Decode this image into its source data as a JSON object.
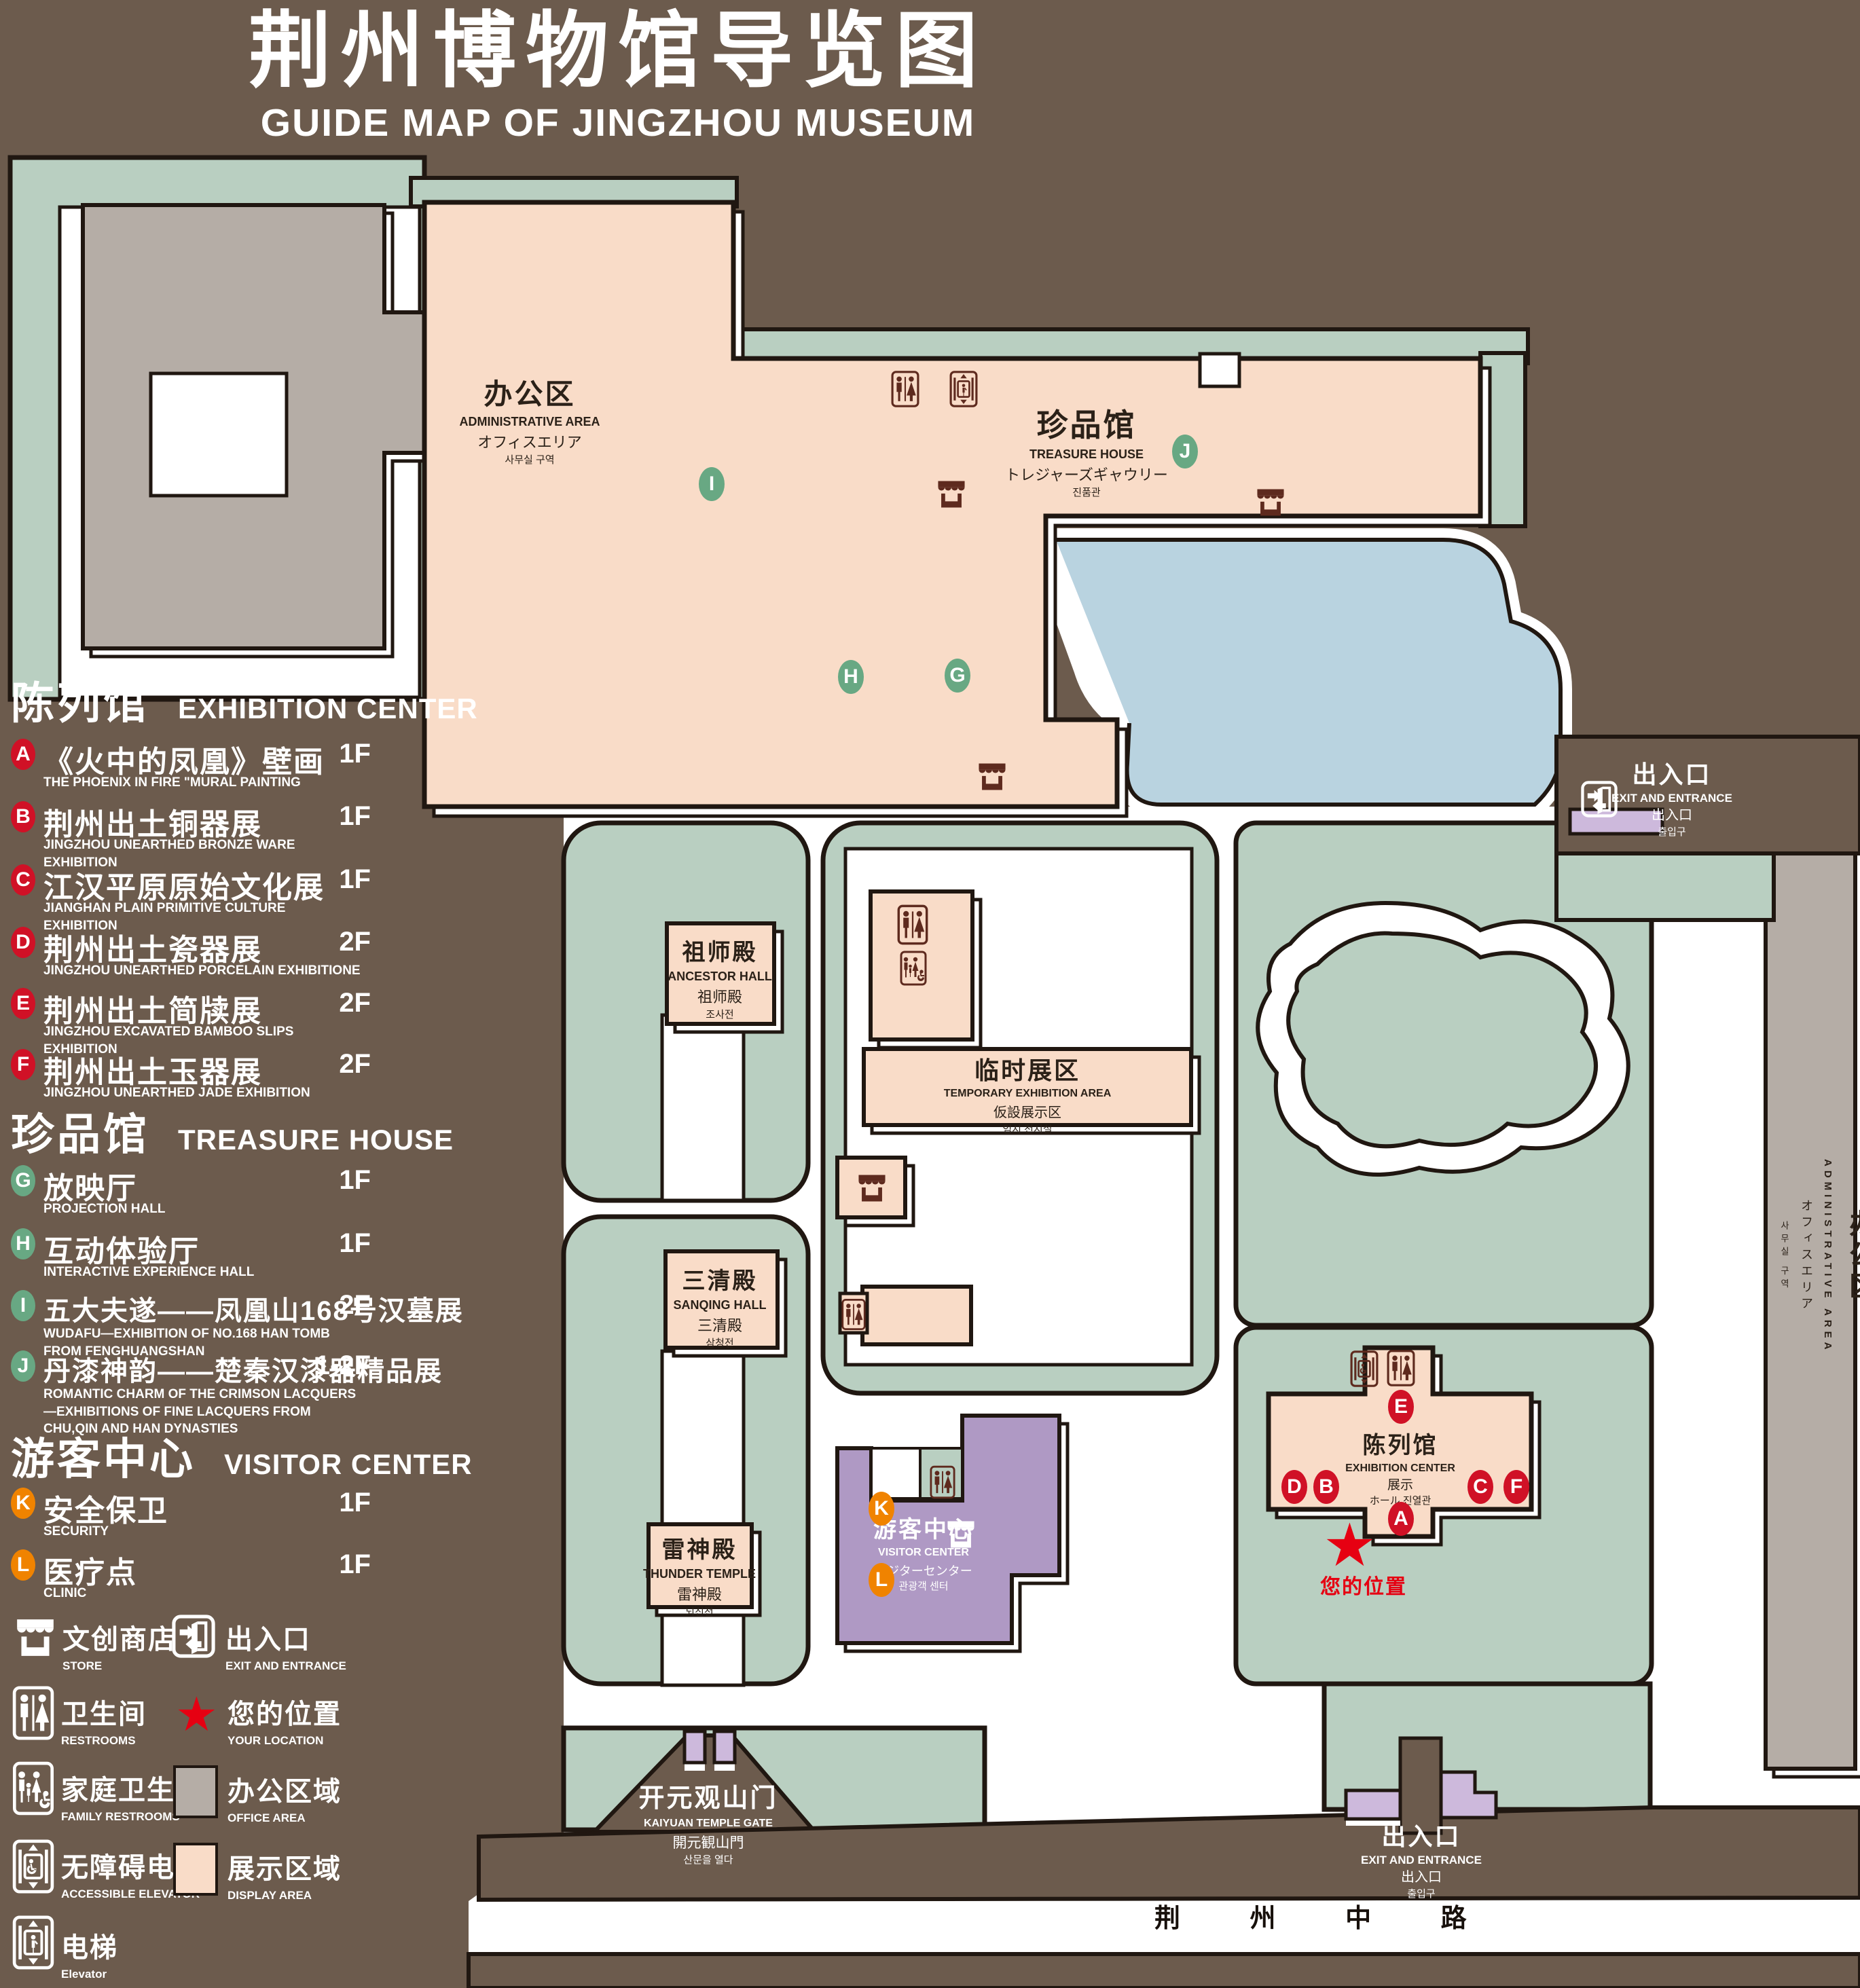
{
  "title": {
    "zh": "荆州博物馆导览图",
    "en": "GUIDE MAP OF JINGZHOU MUSEUM"
  },
  "icons": {
    "star": "★"
  },
  "legend": {
    "sections": [
      {
        "zh": "陈列馆",
        "en": "EXHIBITION CENTER",
        "items": [
          {
            "letter": "A",
            "zh": "《火中的凤凰》壁画",
            "en": "THE PHOENIX IN FIRE \"MURAL PAINTING",
            "floor": "1F"
          },
          {
            "letter": "B",
            "zh": "荆州出土铜器展",
            "en": "JINGZHOU UNEARTHED BRONZE WARE EXHIBITION",
            "floor": "1F"
          },
          {
            "letter": "C",
            "zh": "江汉平原原始文化展",
            "en": "JIANGHAN PLAIN PRIMITIVE CULTURE EXHIBITION",
            "floor": "1F"
          },
          {
            "letter": "D",
            "zh": "荆州出土瓷器展",
            "en": "JINGZHOU UNEARTHED PORCELAIN EXHIBITIONE",
            "floor": "2F"
          },
          {
            "letter": "E",
            "zh": "荆州出土简牍展",
            "en": "JINGZHOU EXCAVATED BAMBOO SLIPS EXHIBITION",
            "floor": "2F"
          },
          {
            "letter": "F",
            "zh": "荆州出土玉器展",
            "en": "JINGZHOU UNEARTHED JADE EXHIBITION",
            "floor": "2F"
          }
        ]
      },
      {
        "zh": "珍品馆",
        "en": "TREASURE HOUSE",
        "items": [
          {
            "letter": "G",
            "zh": "放映厅",
            "en": "PROJECTION HALL",
            "floor": "1F"
          },
          {
            "letter": "H",
            "zh": "互动体验厅",
            "en": "INTERACTIVE EXPERIENCE HALL",
            "floor": "1F"
          },
          {
            "letter": "I",
            "zh": "五大夫遂——凤凰山168号汉墓展",
            "en": "WUDAFU—EXHIBITION OF NO.168 HAN TOMB FROM FENGHUANGSHAN",
            "floor": "2F"
          },
          {
            "letter": "J",
            "zh": "丹漆神韵——楚秦汉漆器精品展",
            "en": "ROMANTIC CHARM OF THE CRIMSON LACQUERS—EXHIBITIONS OF FINE LACQUERS FROM CHU,QIN AND HAN DYNASTIES",
            "floor": "1-2F"
          }
        ]
      },
      {
        "zh": "游客中心",
        "en": "VISITOR CENTER",
        "items": [
          {
            "letter": "K",
            "zh": "安全保卫",
            "en": "SECURITY",
            "floor": "1F"
          },
          {
            "letter": "L",
            "zh": "医疗点",
            "en": "CLINIC",
            "floor": "1F"
          }
        ]
      }
    ],
    "symbols": {
      "store": {
        "zh": "文创商店",
        "en": "STORE"
      },
      "exit": {
        "zh": "出入口",
        "en": "EXIT AND ENTRANCE"
      },
      "restrooms": {
        "zh": "卫生间",
        "en": "RESTROOMS"
      },
      "location": {
        "zh": "您的位置",
        "en": "YOUR LOCATION"
      },
      "family": {
        "zh": "家庭卫生间",
        "en": "FAMILY RESTROOMS"
      },
      "office": {
        "zh": "办公区域",
        "en": "OFFICE AREA"
      },
      "accessible": {
        "zh": "无障碍电梯",
        "en": "ACCESSIBLE ELEVATOR"
      },
      "display": {
        "zh": "展示区域",
        "en": "DISPLAY AREA"
      },
      "elevator": {
        "zh": "电梯",
        "en": "Elevator"
      }
    }
  },
  "map": {
    "buildings": {
      "admin_tl": {
        "zh": "办公区",
        "en": "ADMINISTRATIVE AREA",
        "ja": "オフィスエリア",
        "ko": "사무실 구역"
      },
      "treasure": {
        "zh": "珍品馆",
        "en": "TREASURE HOUSE",
        "ja": "トレジャーズギャウリー",
        "ko": "진품관"
      },
      "ancestor": {
        "zh": "祖师殿",
        "en": "ANCESTOR HALL",
        "ja": "祖师殿",
        "ko": "조사전"
      },
      "temporary": {
        "zh": "临时展区",
        "en": "TEMPORARY EXHIBITION AREA",
        "ja": "仮設展示区",
        "ko": "임시 전시실"
      },
      "sanqing": {
        "zh": "三清殿",
        "en": "SANQING HALL",
        "ja": "三清殿",
        "ko": "삼청전"
      },
      "thunder": {
        "zh": "雷神殿",
        "en": "THUNDER TEMPLE",
        "ja": "雷神殿",
        "ko": "뇌신전"
      },
      "exhibition": {
        "zh": "陈列馆",
        "en": "EXHIBITION CENTER",
        "ja": "展示",
        "ko": "ホール 진열관"
      },
      "visitor": {
        "zh": "游客中心",
        "en": "VISITOR CENTER",
        "ja": "ビジターセンター",
        "ko": "관광객 센터"
      },
      "admin_right": {
        "zh": "办公区",
        "en": "ADMINISTRATIVE AREA",
        "ja": "オフィスエリア",
        "ko": "사무실 구역"
      },
      "gate": {
        "zh": "开元观山门",
        "en": "KAIYUAN TEMPLE GATE",
        "ja": "開元観山門",
        "ko": "산문을 열다"
      },
      "exit_top": {
        "zh": "出入口",
        "en": "EXIT AND ENTRANCE",
        "ja": "出入口",
        "ko": "출입구"
      },
      "exit_bottom": {
        "zh": "出入口",
        "en": "EXIT AND ENTRANCE",
        "ja": "出入口",
        "ko": "출입구"
      },
      "road": {
        "zh": "荆 州 中 路"
      }
    },
    "markers": {
      "a": "A",
      "b": "B",
      "c": "C",
      "d": "D",
      "e": "E",
      "f": "F",
      "g": "G",
      "h": "H",
      "i": "I",
      "j": "J",
      "k": "K",
      "l": "L"
    },
    "your_location": "您的位置"
  }
}
